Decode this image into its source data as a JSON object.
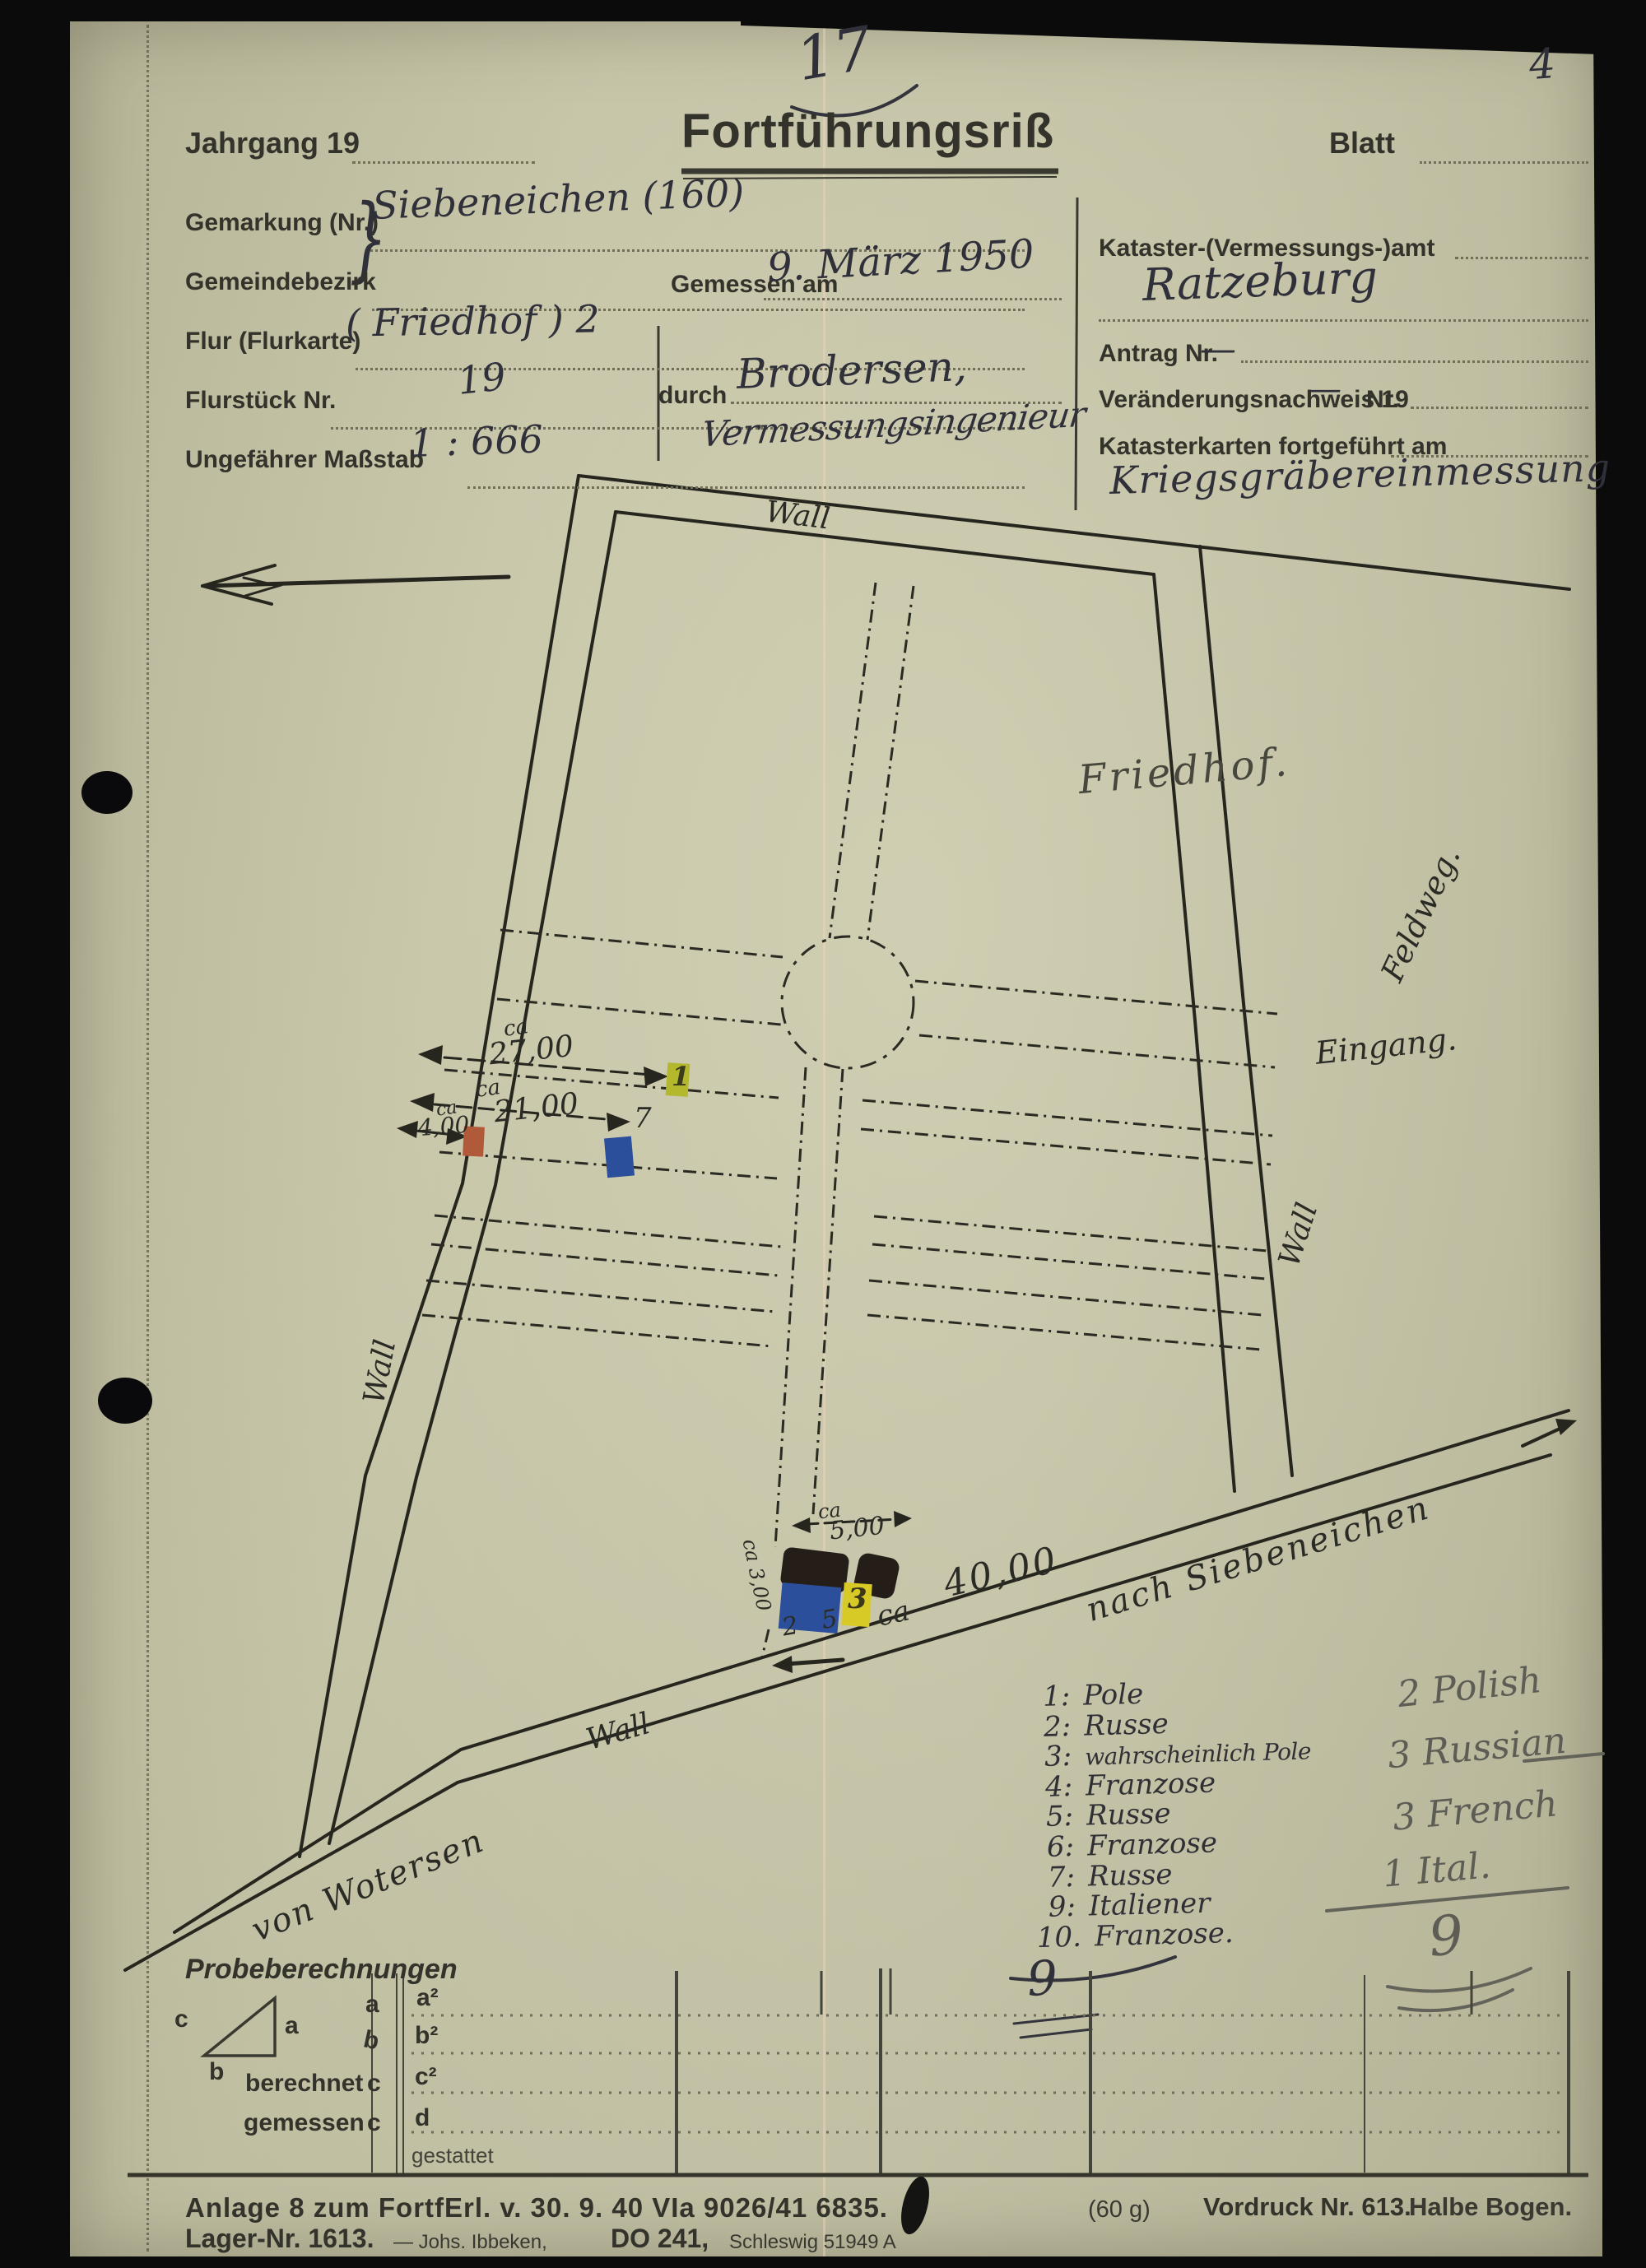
{
  "page": {
    "corner_number": "17",
    "page_number": "4"
  },
  "header": {
    "jahrgang": "Jahrgang 19",
    "title": "Fortführungsriß",
    "blatt": "Blatt"
  },
  "form": {
    "gemarkung_label": "Gemarkung (Nr.)",
    "gemarkung_value": "Siebeneichen (160)",
    "brace": "}",
    "gemeindebezirk_label": "Gemeindebezirk",
    "flur_label": "Flur (Flurkarte)",
    "flur_value": "( Friedhof ) 2",
    "flurstueck_label": "Flurstück Nr.",
    "flurstueck_value": "19",
    "massstab_label": "Ungefährer Maßstab",
    "massstab_value": "1 : 666",
    "gemessen_label": "Gemessen am",
    "gemessen_value": "9. März 1950",
    "durch_label": "durch",
    "durch_value": "Brodersen,",
    "durch_value2": "Vermessungsingenieur",
    "amt_label": "Kataster-(Vermessungs-)amt",
    "amt_value": "Ratzeburg",
    "antrag_label": "Antrag Nr.",
    "antrag_value": "—",
    "vn_label": "Veränderungsnachweis 19",
    "vn_dash": "—",
    "vn_nr": "Nr.",
    "karten_label": "Katasterkarten fortgeführt am",
    "karten_value": "Kriegsgräbereinmessung"
  },
  "map": {
    "wall_top": "Wall",
    "wall_left": "Wall",
    "wall_right": "Wall",
    "wall_bottom": "Wall",
    "friedhof": "Friedhof.",
    "feldweg": "Feldweg.",
    "eingang": "Eingang.",
    "nach": "nach Siebeneichen",
    "von": "von Wotersen",
    "m1_ca": "ca",
    "m1": "27,00",
    "m2_ca": "ca",
    "m2": "21,00",
    "m3_ca": "ca",
    "m3": "4,00",
    "m4_ca": "ca",
    "m4": "5,00",
    "m5": "ca 3,00",
    "m6_ca": "ca",
    "m6": "40,00",
    "g1": "1",
    "g7": "7",
    "g3": "3",
    "g25": "2 5"
  },
  "legend": {
    "items": [
      {
        "n": "1:",
        "t": "Pole"
      },
      {
        "n": "2:",
        "t": "Russe"
      },
      {
        "n": "3:",
        "t": "wahrscheinlich Pole"
      },
      {
        "n": "4:",
        "t": "Franzose"
      },
      {
        "n": "5:",
        "t": "Russe"
      },
      {
        "n": "6:",
        "t": "Franzose"
      },
      {
        "n": "7:",
        "t": "Russe"
      },
      {
        "n": "9:",
        "t": "Italiener"
      },
      {
        "n": "10.",
        "t": "Franzose."
      }
    ]
  },
  "pencil": {
    "l1": "2 Polish",
    "l2": "3 Russian",
    "l3": "3 French",
    "l4": "1 Ital.",
    "total": "9",
    "total2": "9"
  },
  "probe": {
    "heading": "Probeberechnungen",
    "tri_a": "a",
    "tri_b": "b",
    "tri_c": "c",
    "r1": "a",
    "r2": "b",
    "r3": "berechnet",
    "r3c": "c",
    "r4": "gemessen",
    "r4c": "c",
    "c1": "a²",
    "c2": "b²",
    "c3": "c²",
    "c4": "d",
    "c5": "gestattet"
  },
  "footer": {
    "line1": "Anlage 8 zum FortfErl. v. 30. 9. 40 VIa 9026/41 6835.",
    "weight": "(60 g)",
    "lager": "Lager-Nr. 1613.",
    "printer": "— Johs. Ibbeken,",
    "do": "DO 241,",
    "ort": "Schleswig 51949 A",
    "vordruck": "Vordruck Nr. 613.",
    "halbe": "Halbe Bogen."
  },
  "colors": {
    "paper": "#cac8aa",
    "ink": "#2f2f35",
    "map_ink": "#26261f",
    "pencil": "#5d5d55",
    "mark_yellow": "#b4b82c",
    "mark_red": "#b15a3a",
    "mark_blue": "#2c4f9c",
    "mark_dark": "#251d18",
    "mark_gold": "#d7c926"
  }
}
